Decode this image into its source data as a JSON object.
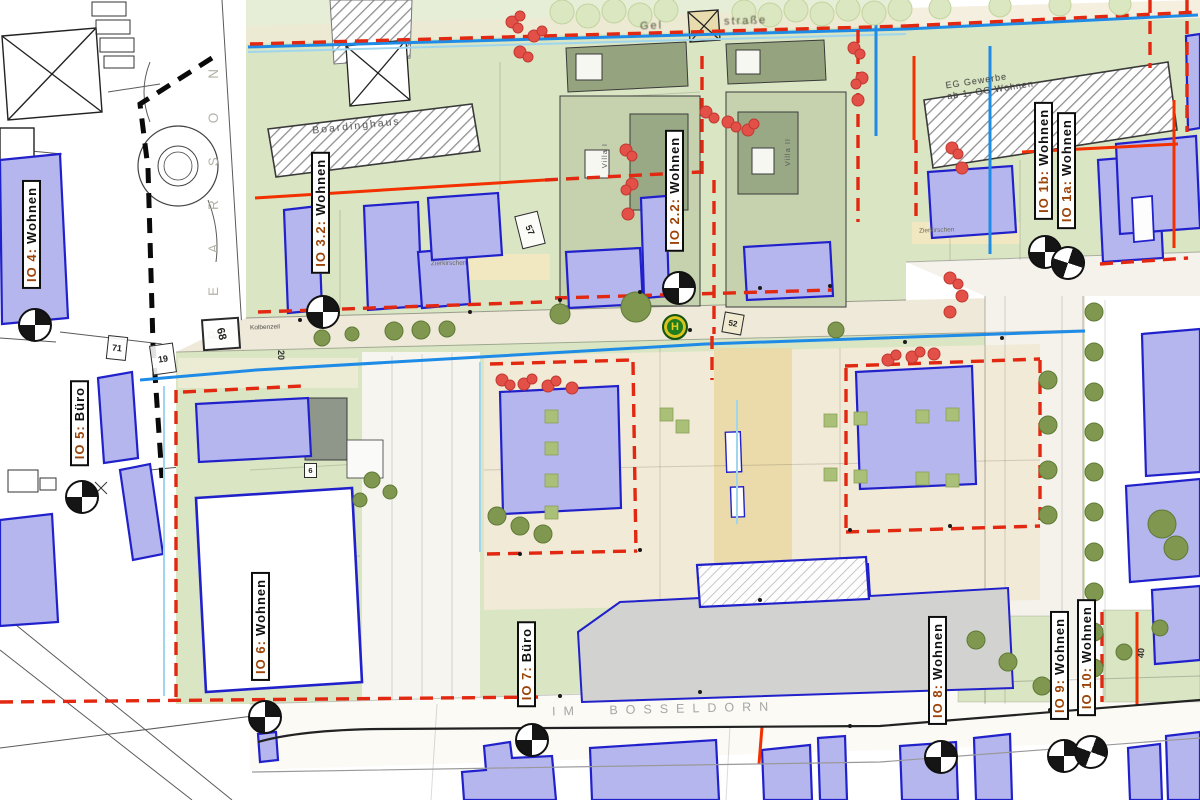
{
  "io_labels": [
    {
      "id": "io-4",
      "prefix": "IO 4:",
      "use": "Wohnen"
    },
    {
      "id": "io-5",
      "prefix": "IO 5:",
      "use": "Büro"
    },
    {
      "id": "io-3-2",
      "prefix": "IO 3.2:",
      "use": "Wohnen"
    },
    {
      "id": "io-2-2",
      "prefix": "IO 2.2:",
      "use": "Wohnen"
    },
    {
      "id": "io-1b",
      "prefix": "IO 1b:",
      "use": "Wohnen"
    },
    {
      "id": "io-1a",
      "prefix": "IO 1a:",
      "use": "Wohnen"
    },
    {
      "id": "io-6",
      "prefix": "IO 6:",
      "use": "Wohnen"
    },
    {
      "id": "io-7",
      "prefix": "IO 7:",
      "use": "Büro"
    },
    {
      "id": "io-8",
      "prefix": "IO 8:",
      "use": "Wohnen"
    },
    {
      "id": "io-9",
      "prefix": "IO 9:",
      "use": "Wohnen"
    },
    {
      "id": "io-10",
      "prefix": "IO 10:",
      "use": "Wohnen"
    }
  ],
  "streets": {
    "bottom": "IM BOSSELDORN",
    "mid": "Kolbenzeil",
    "west_letters": "PEARSON",
    "top_fragment_left": "Gel",
    "top_fragment_right": "straße"
  },
  "buildings": {
    "boardinghaus": "Boardinghaus",
    "gewerbe_line1": "EG Gewerbe",
    "gewerbe_line2": "ab 1. OG Wohnen",
    "villa_1": "Villa I",
    "villa_2": "Villa II",
    "zierkirschen_west": "Zierkirschen",
    "zierkirschen_east": "Zierkirschen"
  },
  "parcel_numbers": {
    "n57": "57",
    "n71": "71",
    "n19": "19",
    "n68": "68",
    "n20": "20",
    "n6": "6",
    "n52": "52",
    "n40": "40"
  },
  "transit": {
    "bus_stop_symbol": "H"
  },
  "legend_colors": {
    "building_fill": "#b6b6ef",
    "building_outline": "#2121cb",
    "boundary_red": "#e22810",
    "line_blue": "#1e8ce6",
    "line_cyan": "#9fd6ee",
    "block_green": "#d9e5c3",
    "plaza_cream": "#f1ead6"
  }
}
